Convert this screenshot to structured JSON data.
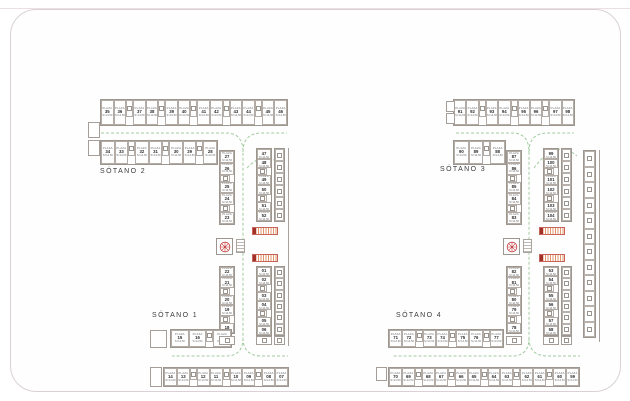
{
  "legend": {
    "stall_label": "PLAZA",
    "stall_area": "S=14,50"
  },
  "floors": [
    {
      "id": "s2",
      "label": "SÓTANO 2",
      "bands": {
        "top_row": [
          "35",
          "36",
          "37",
          "38",
          "39",
          "40",
          "41",
          "42",
          "43",
          "44",
          "45",
          "46"
        ],
        "second_row": [
          "34",
          "33",
          "32",
          "31",
          "30",
          "29",
          "28"
        ],
        "col_inner": [
          "27",
          "26",
          "25",
          "24",
          "23"
        ],
        "col_right": [
          "47",
          "48",
          "49",
          "50",
          "51",
          "52"
        ]
      }
    },
    {
      "id": "s1",
      "label": "SÓTANO 1",
      "bands": {
        "col_inner": [
          "22",
          "21",
          "20",
          "19",
          "18"
        ],
        "col_right": [
          "01",
          "02",
          "03",
          "04",
          "05",
          "06"
        ],
        "mid_row": [
          "15",
          "16",
          "17"
        ],
        "bottom_row": [
          "14",
          "13",
          "12",
          "11",
          "10",
          "09",
          "08",
          "07"
        ]
      }
    },
    {
      "id": "s3",
      "label": "SÓTANO 3",
      "bands": {
        "top_row": [
          "91",
          "92",
          "93",
          "94",
          "95",
          "96",
          "97",
          "98"
        ],
        "second_row": [
          "90",
          "89",
          "88"
        ],
        "col_inner": [
          "87",
          "86",
          "85",
          "84",
          "83"
        ],
        "col_right": [
          "99",
          "100",
          "101",
          "102",
          "103",
          "104"
        ]
      }
    },
    {
      "id": "s4",
      "label": "SÓTANO 4",
      "bands": {
        "col_inner": [
          "82",
          "81",
          "80",
          "79",
          "78"
        ],
        "col_right": [
          "53",
          "54",
          "55",
          "56",
          "57",
          "58"
        ],
        "mid_row": [
          "71",
          "72",
          "73",
          "74",
          "75",
          "76",
          "77"
        ],
        "bottom_row": [
          "70",
          "69",
          "68",
          "67",
          "66",
          "65",
          "64",
          "63",
          "62",
          "61",
          "60",
          "59"
        ]
      }
    }
  ],
  "colors": {
    "drive_path": "#9cc89c",
    "accent_red": "#c03030",
    "ramp_orange": "#e2956a",
    "wall": "#a8a29c",
    "sheet_border": "#d9d1d6"
  }
}
